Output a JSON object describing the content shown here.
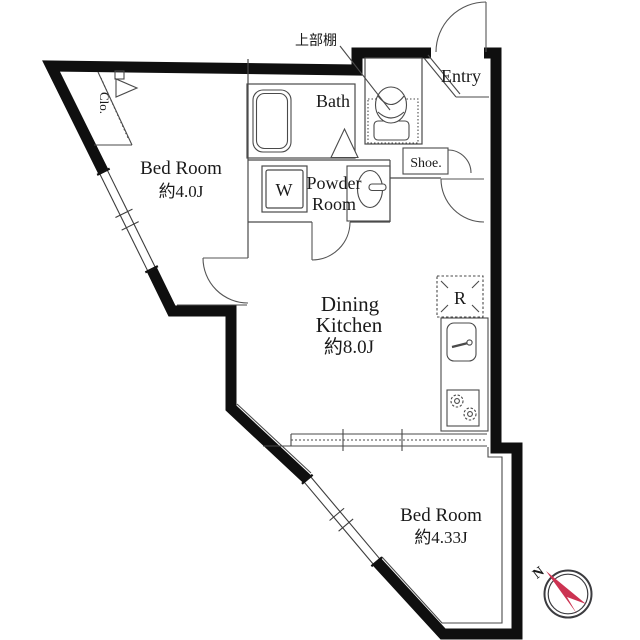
{
  "plan": {
    "title": "apartment-floor-plan",
    "rooms": {
      "bedroom1": {
        "name": "Bed Room",
        "size": "約4.0J"
      },
      "bedroom2": {
        "name": "Bed Room",
        "size": "約4.33J"
      },
      "dining_kitchen": {
        "line1": "Dining",
        "line2": "Kitchen",
        "size": "約8.0J"
      },
      "bath": {
        "name": "Bath"
      },
      "powder": {
        "line1": "Powder",
        "line2": "Room"
      },
      "entry": {
        "name": "Entry"
      }
    },
    "labels": {
      "closet": "Clo.",
      "shoe_cabinet": "Shoe.",
      "washer": "W",
      "refrigerator": "R",
      "upper_shelf": "上部棚",
      "compass_north": "N"
    },
    "colors": {
      "wall": "#0f0f0f",
      "thin_line": "#4a4a4a",
      "accent_compass": "#cc3352",
      "background": "#ffffff"
    }
  }
}
